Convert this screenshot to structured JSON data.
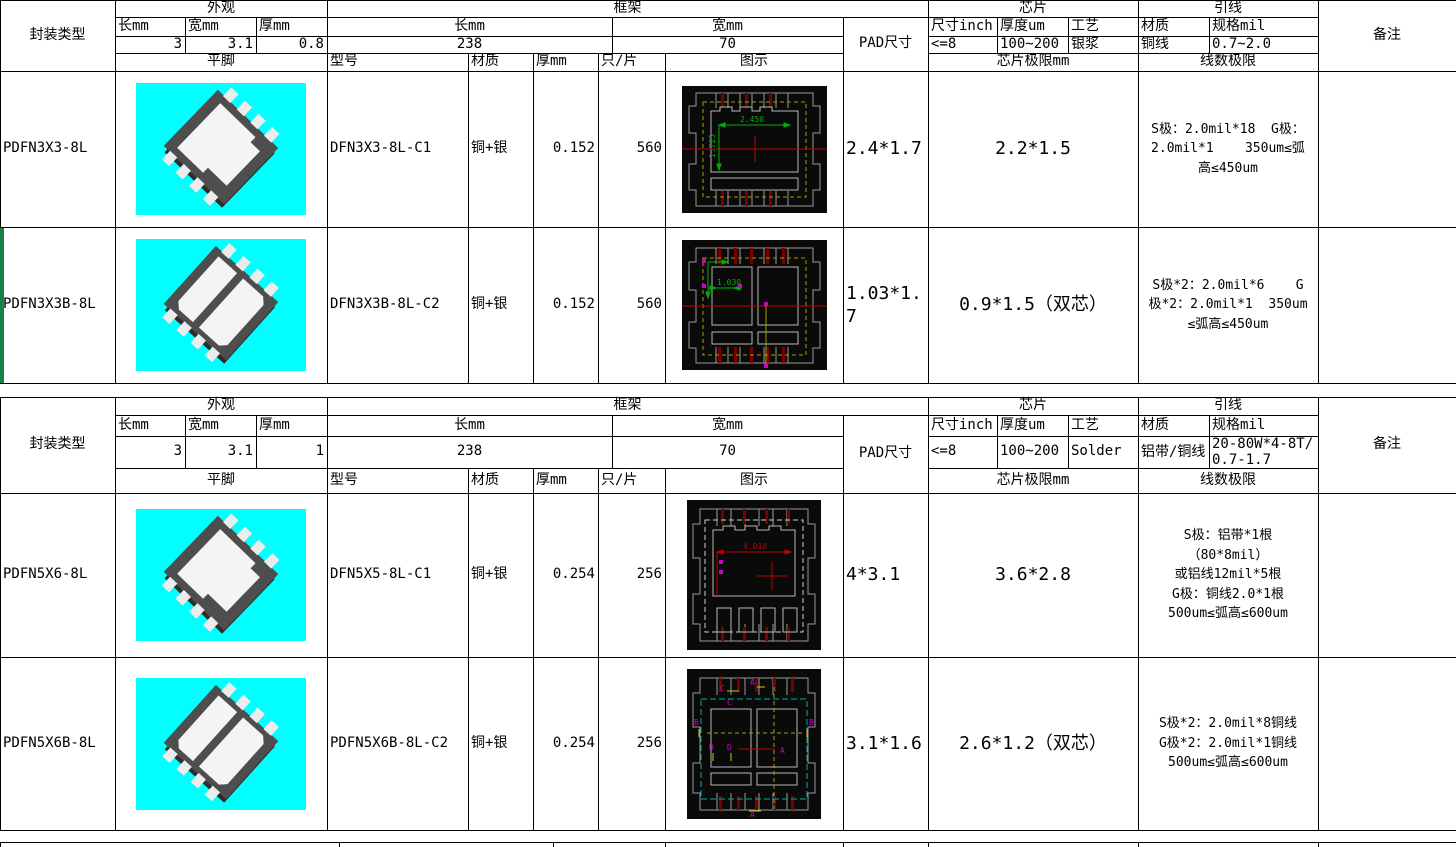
{
  "colors": {
    "grid_line": "#000000",
    "highlight_green": "#1a8048",
    "photo_bg_cyan": "#00ffff",
    "package_body_gray": "#4e4e4e",
    "pad_white": "#f4f4f4",
    "cad_bg_black": "#0a0a0a",
    "cad_outline_gray": "#9a9a9a",
    "cad_yellow": "#a0a000",
    "cad_red": "#bb0000",
    "cad_green": "#00b000",
    "cad_magenta": "#cc00cc",
    "cad_cyan": "#00a8a8",
    "cad_darkred": "#7a0000"
  },
  "tables": [
    {
      "header": {
        "package_type_label": "封装类型",
        "appearance": {
          "label": "外观",
          "len_label": "长mm",
          "wid_label": "宽mm",
          "thk_label": "厚mm",
          "len": "3",
          "wid": "3.1",
          "thk": "0.8"
        },
        "frame": {
          "label": "框架",
          "len_label": "长mm",
          "wid_label": "宽mm",
          "len": "238",
          "wid": "70"
        },
        "pad_label": "PAD尺寸",
        "chip": {
          "label": "芯片",
          "size_label": "尺寸inch",
          "thickness_label": "厚度um",
          "process_label": "工艺",
          "size": "<=8",
          "thickness": "100~200",
          "process": "银浆"
        },
        "wire": {
          "label": "引线",
          "material_label": "材质",
          "spec_label": "规格mil",
          "material": "铜线",
          "spec": "0.7~2.0"
        },
        "remark_label": "备注",
        "flat_pin_label": "平脚",
        "model_label": "型号",
        "material_label": "材质",
        "thickness_label": "厚mm",
        "per_sheet_label": "只/片",
        "diagram_label": "图示",
        "chip_limit_label": "芯片极限mm",
        "wire_limit_label": "线数极限"
      },
      "rows": [
        {
          "package": "PDFN3X3-8L",
          "model": "DFN3X3-8L-C1",
          "material": "铜+银",
          "thickness": "0.152",
          "per_sheet": "560",
          "pad_size": "2.4*1.7",
          "chip_limit": "2.2*1.5",
          "wire_limit_lines": [
            "S极：2.0mil*18  G极：",
            "2.0mil*1    350um≤弧",
            "高≤450um"
          ],
          "diagram": {
            "h_dim": "2.450",
            "v_dim": "1.725"
          },
          "photo": "single-pad",
          "remark": ""
        },
        {
          "package": "PDFN3X3B-8L",
          "model": "DFN3X3B-8L-C2",
          "material": "铜+银",
          "thickness": "0.152",
          "per_sheet": "560",
          "pad_size": "1.03*1.7",
          "chip_limit": "0.9*1.5（双芯）",
          "wire_limit_lines": [
            "S极*2：2.0mil*6    G",
            "极*2：2.0mil*1  350um",
            "≤弧高≤450um"
          ],
          "diagram": {
            "h_dim": "1.030"
          },
          "photo": "dual-pad",
          "remark": ""
        }
      ]
    },
    {
      "header": {
        "package_type_label": "封装类型",
        "appearance": {
          "label": "外观",
          "len_label": "长mm",
          "wid_label": "宽mm",
          "thk_label": "厚mm",
          "len": "3",
          "wid": "3.1",
          "thk": "1"
        },
        "frame": {
          "label": "框架",
          "len_label": "长mm",
          "wid_label": "宽mm",
          "len": "238",
          "wid": "70"
        },
        "pad_label": "PAD尺寸",
        "chip": {
          "label": "芯片",
          "size_label": "尺寸inch",
          "thickness_label": "厚度um",
          "process_label": "工艺",
          "size": "<=8",
          "thickness": "100~200",
          "process": "Solder"
        },
        "wire": {
          "label": "引线",
          "material_label": "材质",
          "spec_label": "规格mil",
          "material": "铝带/铜线",
          "spec": "20-80W*4-8T/0.7-1.7"
        },
        "remark_label": "备注",
        "flat_pin_label": "平脚",
        "model_label": "型号",
        "material_label": "材质",
        "thickness_label": "厚mm",
        "per_sheet_label": "只/片",
        "diagram_label": "图示",
        "chip_limit_label": "芯片极限mm",
        "wire_limit_label": "线数极限"
      },
      "rows": [
        {
          "package": "PDFN5X6-8L",
          "model": "DFN5X5-8L-C1",
          "material": "铜+银",
          "thickness": "0.254",
          "per_sheet": "256",
          "pad_size": "4*3.1",
          "chip_limit": "3.6*2.8",
          "wire_limit_lines": [
            "S极：铝带*1根",
            "（80*8mil）",
            "或铝线12mil*5根",
            "G极：铜线2.0*1根",
            "500um≤弧高≤600um"
          ],
          "diagram": {
            "h_dim": "4.010"
          },
          "photo": "single-pad",
          "remark": ""
        },
        {
          "package": "PDFN5X6B-8L",
          "model": "PDFN5X6B-8L-C2",
          "material": "铜+银",
          "thickness": "0.254",
          "per_sheet": "256",
          "pad_size": "3.1*1.6",
          "chip_limit": "2.6*1.2（双芯）",
          "wire_limit_lines": [
            "S极*2：2.0mil*8铜线",
            "G极*2：2.0mil*1铜线",
            "500um≤弧高≤600um"
          ],
          "diagram": {
            "markers": [
              "A",
              "B",
              "C",
              "D"
            ]
          },
          "photo": "dual-pad",
          "remark": ""
        }
      ]
    }
  ]
}
